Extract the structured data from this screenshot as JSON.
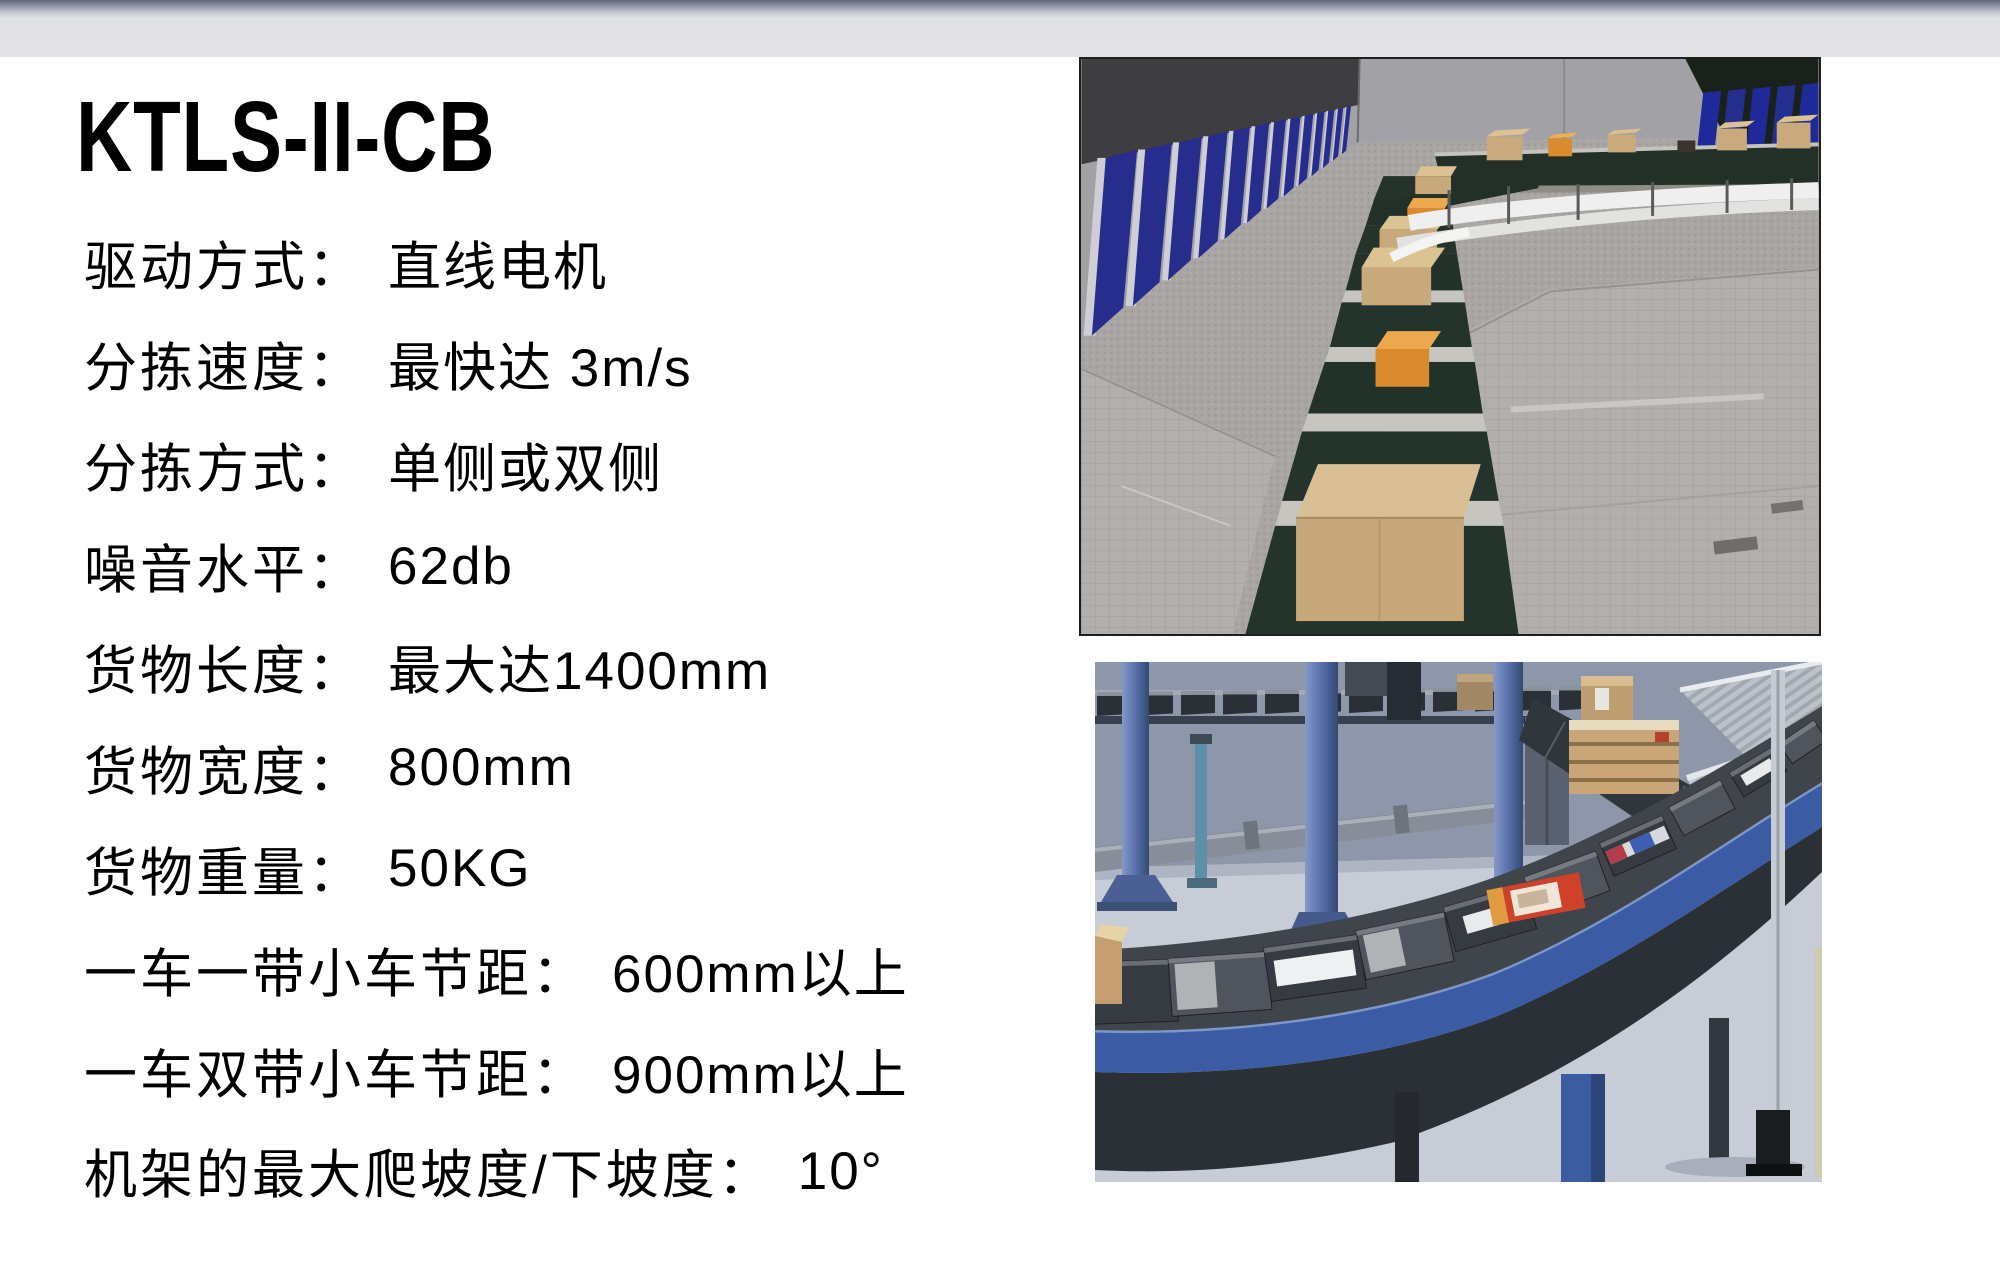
{
  "slide": {
    "header_bar": {
      "gradient_top": "#5f6478",
      "gradient_bottom": "#e4e4e7"
    },
    "title": "KTLS-II-CB",
    "specs": [
      {
        "label": "驱动方式：",
        "value": "直线电机"
      },
      {
        "label": "分拣速度：",
        "value": "最快达 3m/s"
      },
      {
        "label": "分拣方式：",
        "value": "单侧或双侧"
      },
      {
        "label": "噪音水平：",
        "value": "62db"
      },
      {
        "label": "货物长度：",
        "value": "最大达1400mm"
      },
      {
        "label": "货物宽度：",
        "value": "800mm"
      },
      {
        "label": "货物重量：",
        "value": "50KG"
      },
      {
        "label": "一车一带小车节距：",
        "value": "600mm以上"
      },
      {
        "label": "一车双带小车节距：",
        "value": "900mm以上"
      },
      {
        "label": "机架的最大爬坡度/下坡度：",
        "value": "10°"
      }
    ]
  }
}
